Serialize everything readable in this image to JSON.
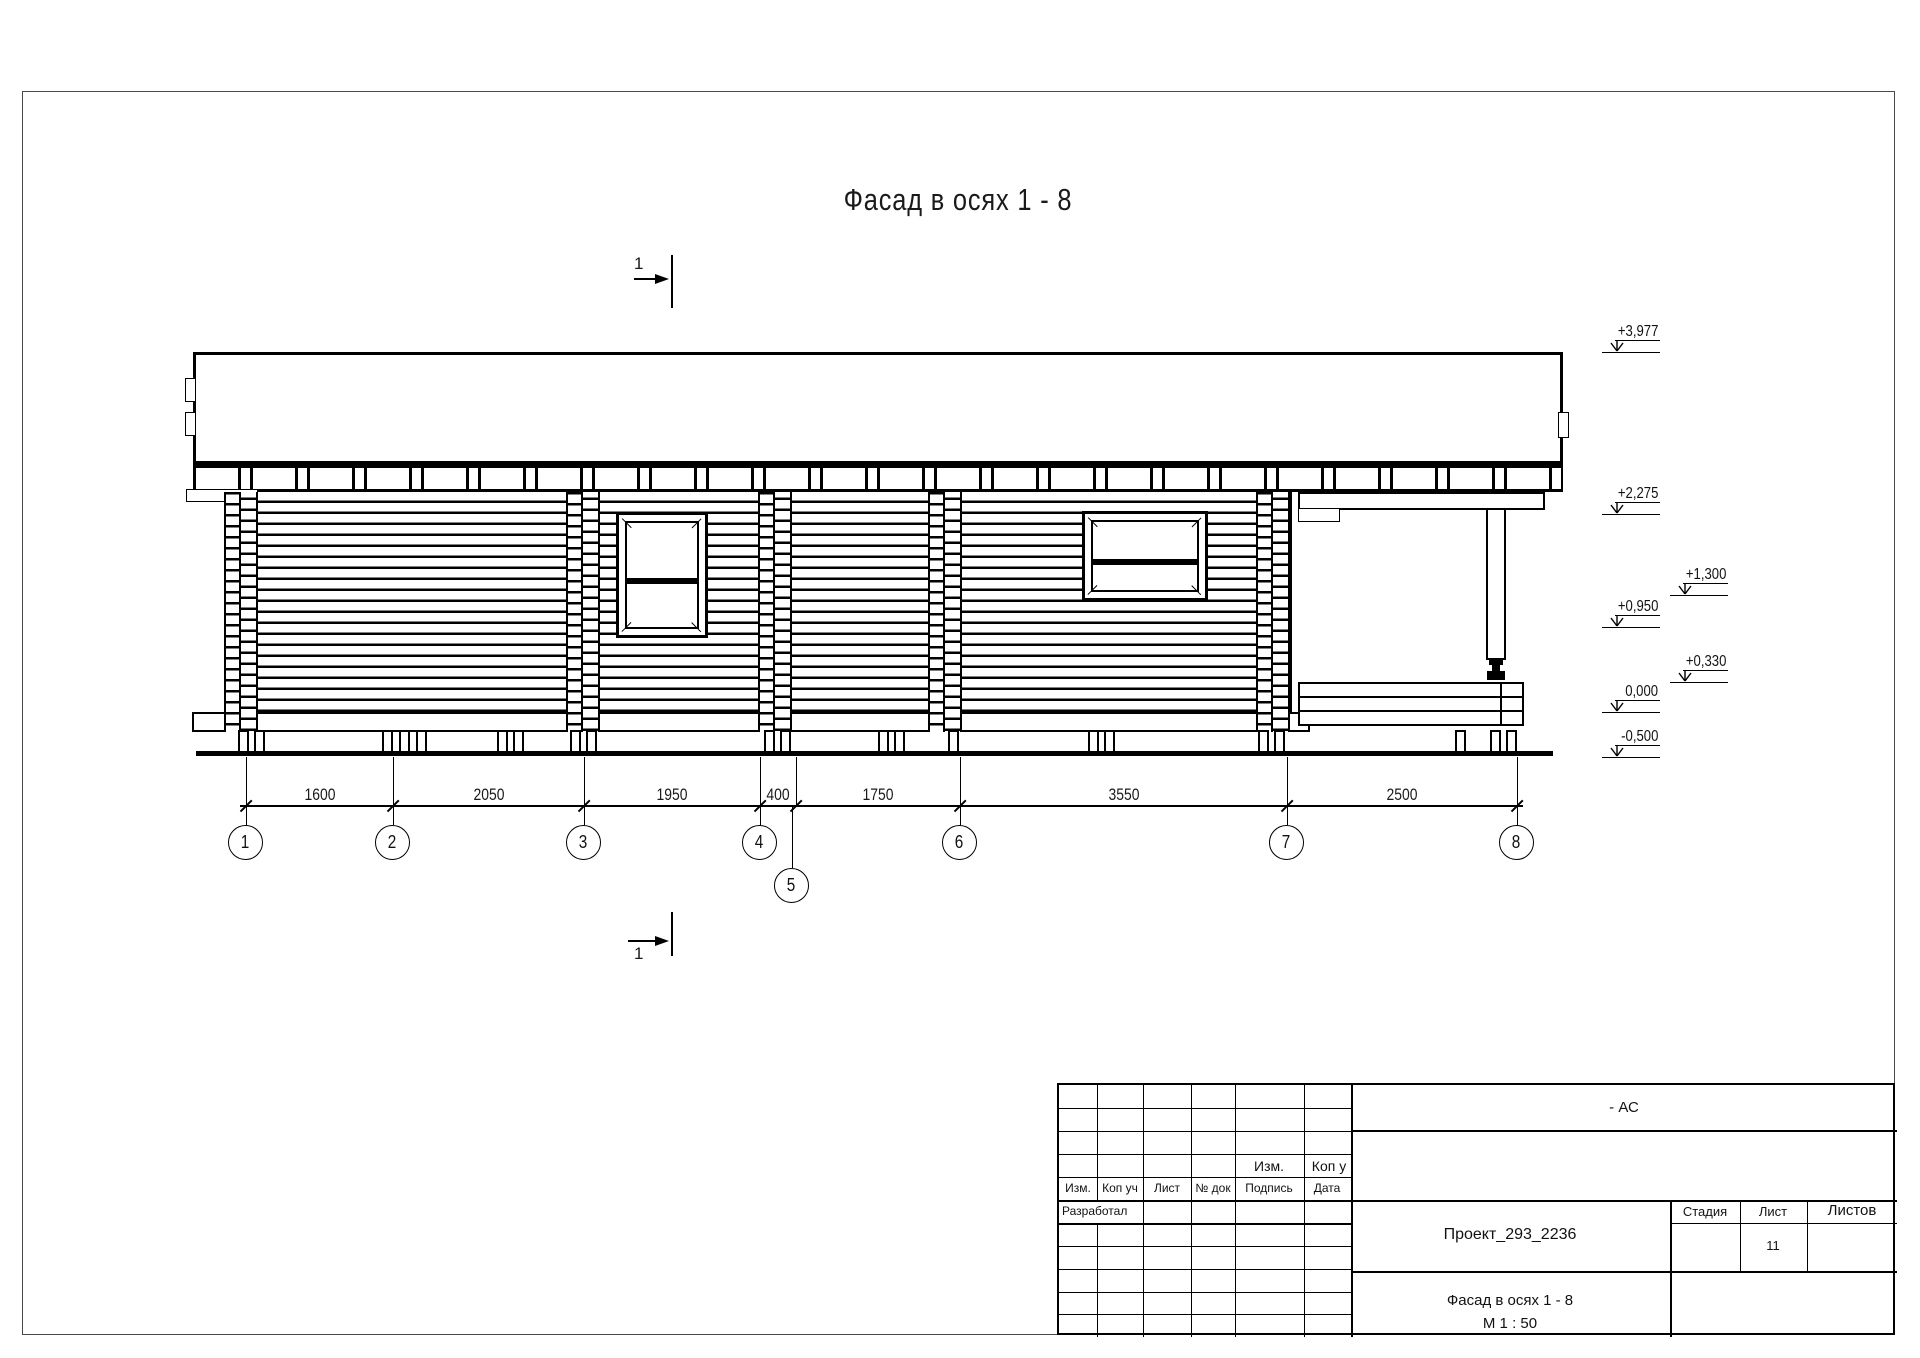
{
  "drawing": {
    "title": "Фасад в осях 1 - 8",
    "section_marker": {
      "top": "1",
      "bottom": "1"
    },
    "dimensions": [
      "1600",
      "2050",
      "1950",
      "400",
      "1750",
      "3550",
      "2500"
    ],
    "axes": [
      "1",
      "2",
      "3",
      "4",
      "5",
      "6",
      "7",
      "8"
    ],
    "elevations": [
      "+3,977",
      "+2,275",
      "+1,300",
      "+0,950",
      "+0,330",
      "0,000",
      "-0,500"
    ]
  },
  "title_block": {
    "doc_code": "- АС",
    "revision_mini": {
      "izm": "Изм.",
      "kop": "Коп у"
    },
    "revision_columns": [
      "Изм.",
      "Коп уч",
      "Лист",
      "№ док",
      "Подпись",
      "Дата"
    ],
    "developed_label": "Разработал",
    "project_name": "Проект_293_2236",
    "stage_label": "Стадия",
    "sheet_label": "Лист",
    "sheets_label": "Листов",
    "sheet_number": "11",
    "drawing_name": "Фасад в осях 1 - 8",
    "scale": "М 1 : 50"
  }
}
